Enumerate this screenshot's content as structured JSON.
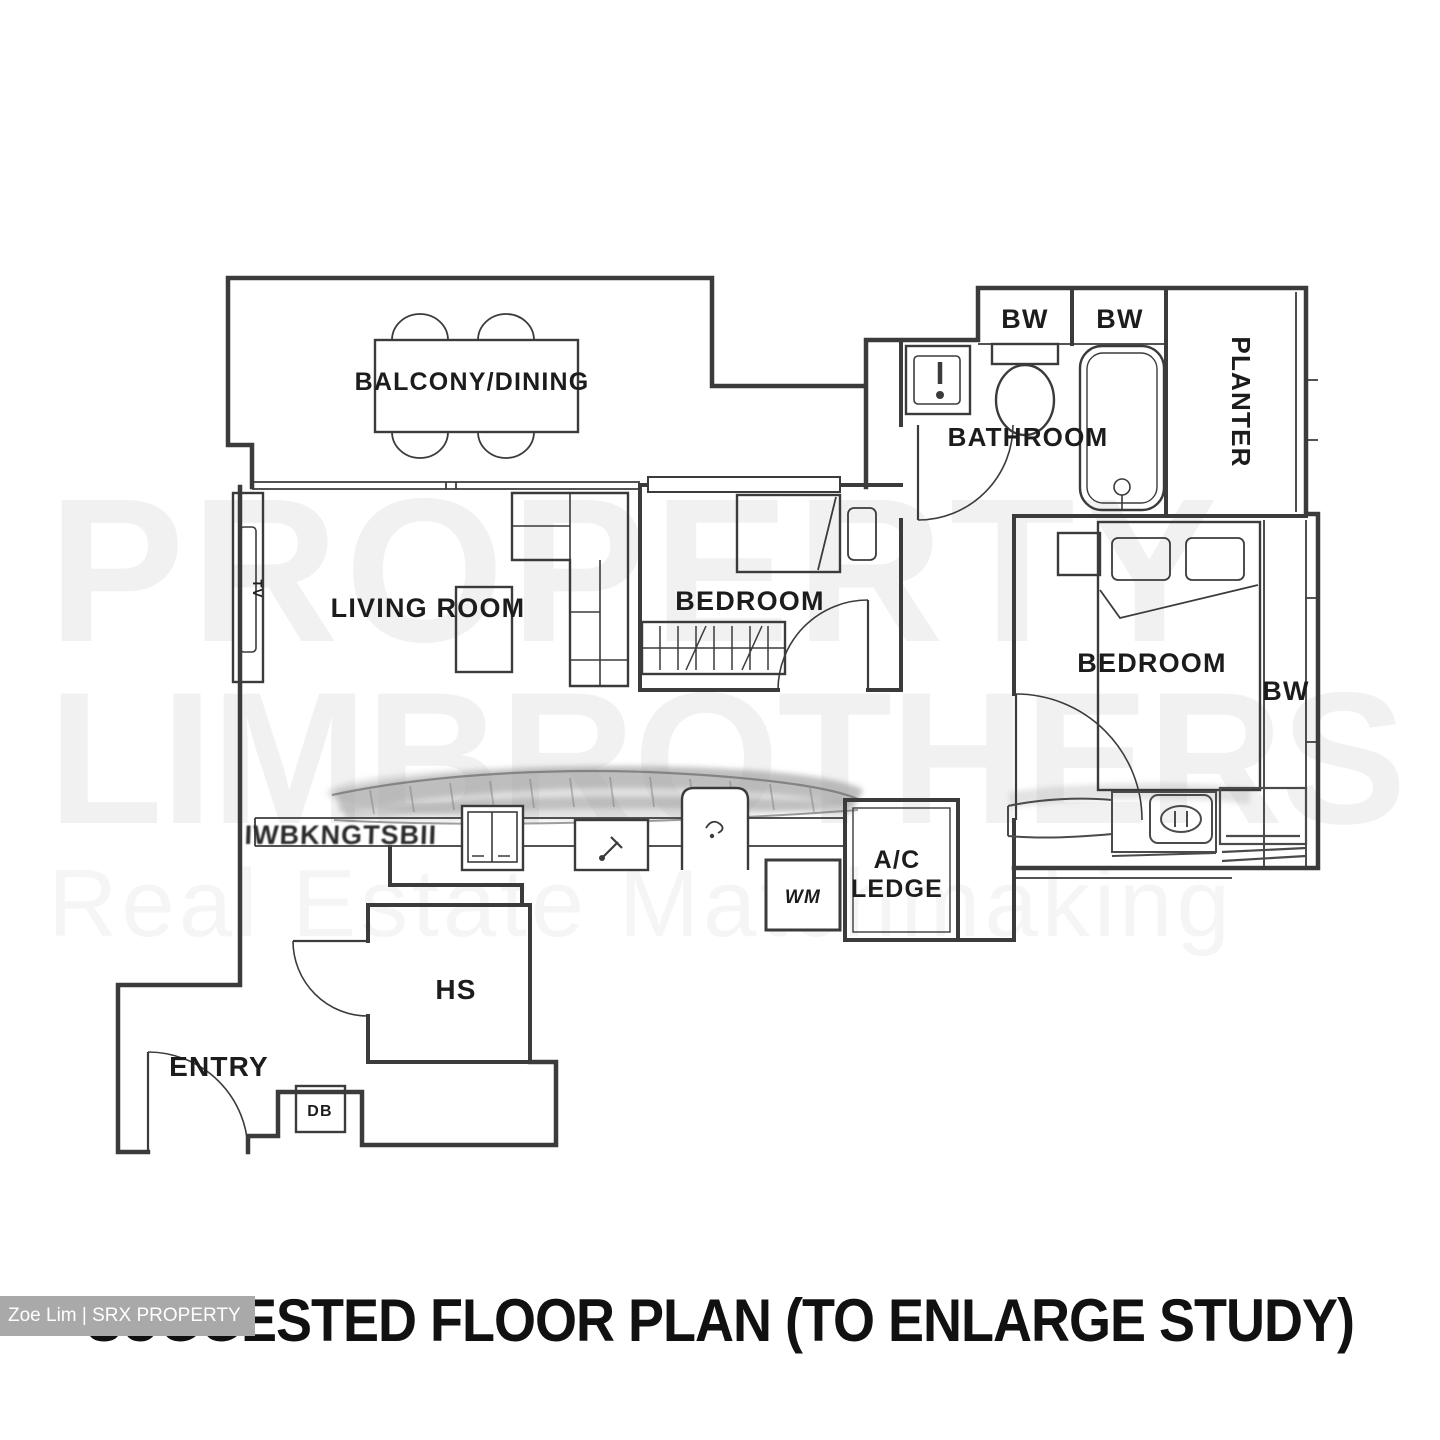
{
  "header": {
    "title": "SUGGESTED FLOOR PLAN (TO ENLARGE STUDY)"
  },
  "badge": {
    "text": "Zoe Lim | SRX PROPERTY"
  },
  "watermark": {
    "line1": "PROPERTY",
    "line2": "LIMBROTHERS",
    "line3": "Real Estate Matchmaking"
  },
  "rooms": {
    "balcony_dining": "BALCONY/DINING",
    "living_room": "LIVING ROOM",
    "bedroom_middle": "BEDROOM",
    "bedroom_right": "BEDROOM",
    "bathroom": "BATHROOM",
    "planter": "PLANTER",
    "ac_ledge_line1": "A/C",
    "ac_ledge_line2": "LEDGE",
    "entry": "ENTRY",
    "household_shelter": "HS"
  },
  "labels": {
    "tv": "TV",
    "bay_window_bathroom_1": "BW",
    "bay_window_bathroom_2": "BW",
    "bay_window_bedroom": "BW",
    "washing_machine": "WM",
    "distribution_board": "DB",
    "smudged_text": "IWBKNGTSBII"
  },
  "colors": {
    "wall": "#3b3b3b",
    "label": "#1c1c1c",
    "watermark": "rgba(0,0,0,0.05)",
    "badge_bg": "#a9a9a9",
    "badge_text": "#ffffff",
    "background": "#ffffff"
  }
}
